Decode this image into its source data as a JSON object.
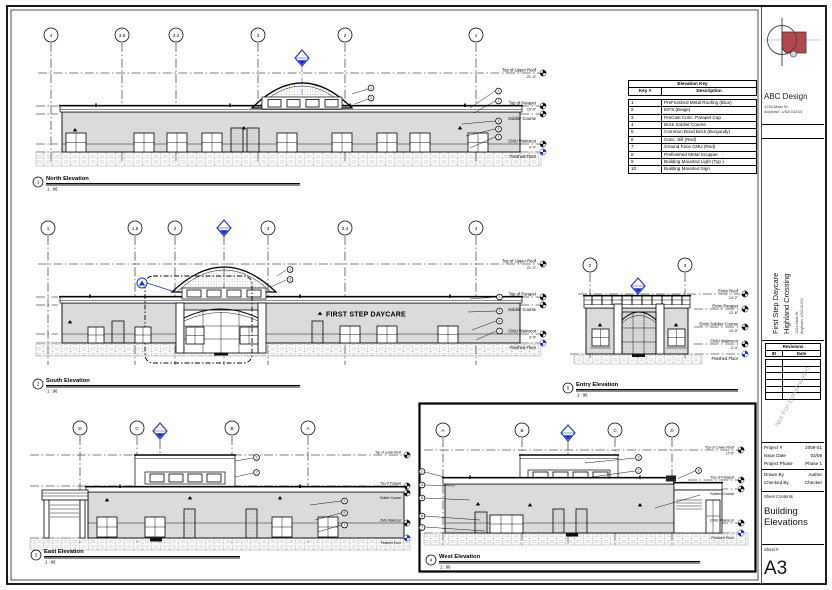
{
  "titleblock": {
    "firm_name": "ABC Design",
    "firm_address1": "1234 Main St.",
    "firm_address2": "Anytown, USA 01234",
    "project_line1": "First Step Daycare",
    "project_line2": "Highland Crossing",
    "project_address1": "1234 Main St.",
    "project_address2": "Anytown, USA 01234",
    "revisions_title": "Revisions",
    "revisions_col_id": "ID",
    "revisions_col_date": "Date",
    "watermark": "Not For Construction",
    "project_number_label": "Project #",
    "project_number": "2009-01",
    "issue_date_label": "Issue Date",
    "issue_date": "03/09",
    "phase_label": "Project Phase",
    "phase": "Phase 1",
    "drawn_by_label": "Drawn By",
    "drawn_by": "Author",
    "checked_by_label": "Checked By",
    "checked_by": "Checker",
    "sheet_contents_label": "Sheet Contents",
    "sheet_contents": "Building Elevations",
    "sheet_number_label": "Sheet #",
    "sheet_number": "A3"
  },
  "key_table": {
    "title": "Elevation Key",
    "col_key": "Key #",
    "col_desc": "Description",
    "rows": [
      {
        "key": "1",
        "desc": "PreFinished Metal Roofing (Blue)"
      },
      {
        "key": "2",
        "desc": "EIFS (Beige)"
      },
      {
        "key": "3",
        "desc": "PreCast Conc. Parapet Cap"
      },
      {
        "key": "4",
        "desc": "Brick Soldier Course"
      },
      {
        "key": "5",
        "desc": "Common Bond Brick (Burgundy)"
      },
      {
        "key": "6",
        "desc": "Conc. Sill (Red)"
      },
      {
        "key": "7",
        "desc": "Ground Face CMU (Red)"
      },
      {
        "key": "8",
        "desc": "Prefinished Metal Scupper"
      },
      {
        "key": "9",
        "desc": "Building Mounted Light (Typ.)"
      },
      {
        "key": "10",
        "desc": "Building Mounted Sign"
      }
    ]
  },
  "views": {
    "north": {
      "num": "1",
      "title": "North Elevation",
      "scale": "1 : 96",
      "grids": [
        "4",
        "3.6",
        "3.2",
        "3",
        "2",
        "1"
      ]
    },
    "south": {
      "num": "2",
      "title": "South Elevation",
      "scale": "1 : 96",
      "grids": [
        "1",
        "1.8",
        "2",
        "3",
        "3.4",
        "4"
      ],
      "sign": "FIRST STEP DAYCARE"
    },
    "east": {
      "num": "3",
      "title": "East Elevation",
      "scale": "1 : 96",
      "grids": [
        "D",
        "C",
        "B",
        "A"
      ]
    },
    "west": {
      "num": "4",
      "title": "West Elevation",
      "scale": "1 : 96",
      "grids": [
        "A",
        "B",
        "C",
        "D"
      ]
    },
    "entry": {
      "num": "5",
      "title": "Entry Elevation",
      "scale": "1 : 96",
      "grids": [
        "2",
        "3"
      ]
    }
  },
  "levels": {
    "upper_roof_label": "Top of Upper Roof",
    "upper_roof_val": "21'-4\"",
    "lower_roof_label": "Top of Lower Roof",
    "lower_roof_val": "17'-6\"",
    "parapet_label": "Top of Parapet",
    "parapet_val": "15'-4\"",
    "soldier_label": "Soldier Course",
    "soldier_val": "12'-8\"",
    "wainscot_label": "CMU Wainscot",
    "wainscot_val": "3'-4\"",
    "floor_label": "Finished Floor",
    "floor_val": "0'-0\"",
    "entry_roof_label": "Entry Roof",
    "entry_roof_val": "14'-2\"",
    "entry_parapet_label": "Entry Parapet",
    "entry_parapet_val": "12'-6\"",
    "entry_soldier_label": "Entry Soldier Course",
    "entry_soldier_val": "10'-0\""
  },
  "keynotes": {
    "n1": "1",
    "n2": "2",
    "n3": "3",
    "n5": "5",
    "n6": "6",
    "n7": "7",
    "n8": "8"
  },
  "colors": {
    "accent_blue": "#1b2fc2",
    "wall_gray": "#dbdbdb",
    "logo_red": "#b2484e"
  }
}
